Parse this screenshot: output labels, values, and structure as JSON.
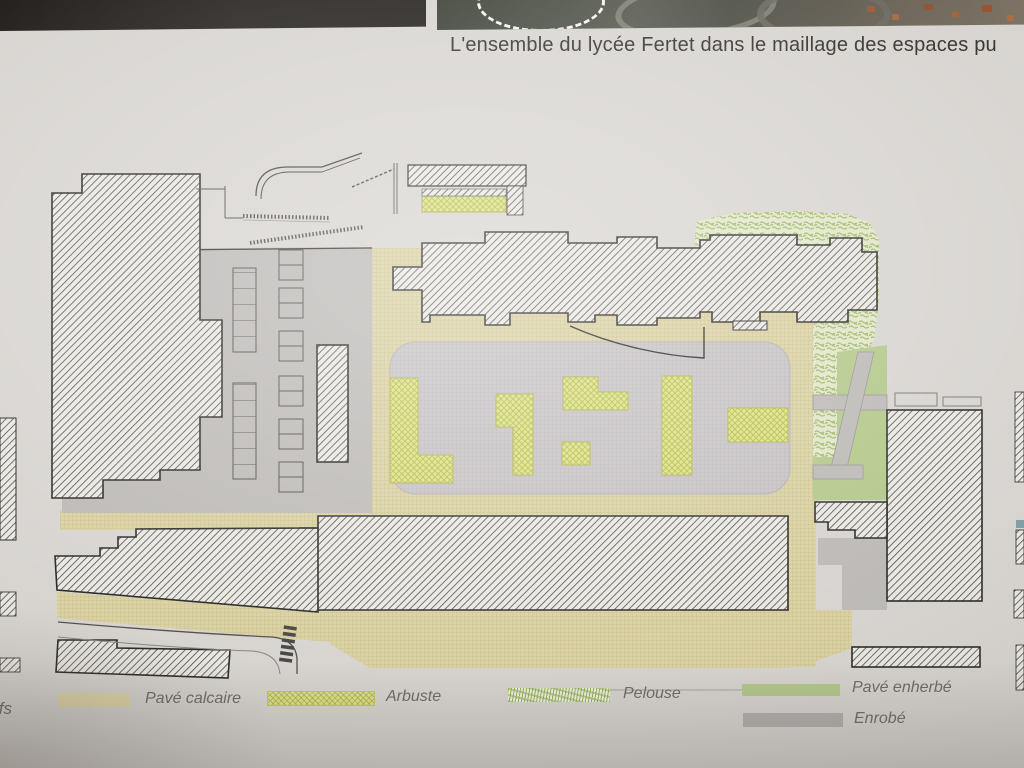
{
  "caption": {
    "text": "L'ensemble du lycée Fertet dans le maillage des espaces pu"
  },
  "legend": {
    "items": [
      {
        "id": "pave-calcaire",
        "label": "Pavé calcaire",
        "swatch": "solid-beige",
        "color": "#e2d7aa"
      },
      {
        "id": "arbuste",
        "label": "Arbuste",
        "swatch": "crosshatch-yellow-green",
        "color": "#dfe383"
      },
      {
        "id": "pelouse",
        "label": "Pelouse",
        "swatch": "scribble-green",
        "color": "#9cb963"
      },
      {
        "id": "pave-enherbe",
        "label": "Pavé enherbé",
        "swatch": "solid-green",
        "color": "#b4c98c"
      },
      {
        "id": "enrobe",
        "label": "Enrobé",
        "swatch": "solid-gray",
        "color": "#b2b0ad"
      }
    ]
  },
  "edge_fragment_text": "ifs",
  "colors": {
    "paper": "#d8d5d1",
    "black_strip": "#26231f",
    "beige_paving": "#dbd2a3",
    "asphalt_gray": "#bdbab7",
    "plaza_gray": "#c7c3c4",
    "arbuste_green": "#dfe383",
    "pelouse_green": "#9cb963",
    "enherbe_green": "#b4c98c",
    "building_hatch_line": "#55534f"
  }
}
